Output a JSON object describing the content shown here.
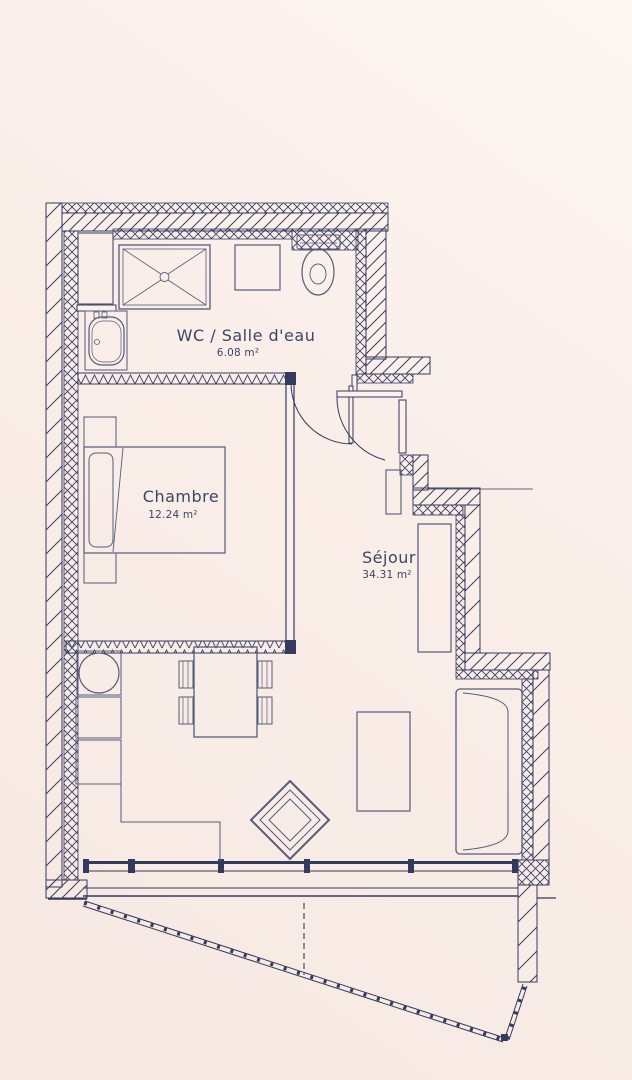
{
  "rooms": [
    {
      "id": "wc",
      "name": "WC / Salle d'eau",
      "area": "6.08 m²"
    },
    {
      "id": "chambre",
      "name": "Chambre",
      "area": "12.24 m²"
    },
    {
      "id": "sejour",
      "name": "Séjour",
      "area": "34.31 m²"
    }
  ],
  "colors": {
    "line": "#343a5e",
    "background": "#f9ece7",
    "text": "#3e4468"
  }
}
